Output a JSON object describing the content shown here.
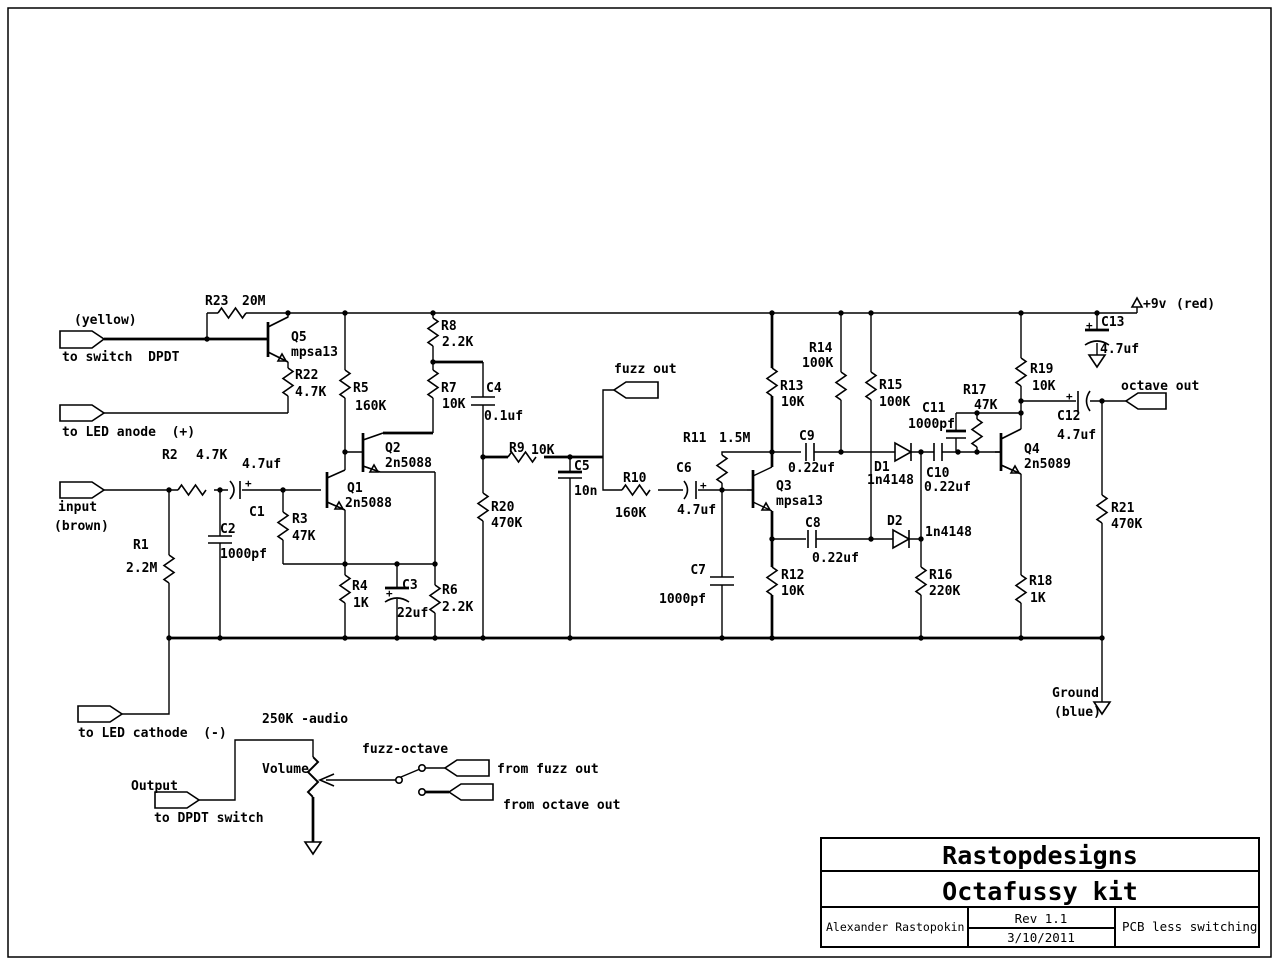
{
  "title_block": {
    "company": "Rastopdesigns",
    "project": "Octafussy kit",
    "author": "Alexander Rastopokin",
    "rev": "Rev 1.1",
    "date": "3/10/2011",
    "note": "PCB less switching"
  },
  "labels": {
    "yellow": "(yellow)",
    "to_switch": "to switch  DPDT",
    "to_led_anode": "to LED anode  (+)",
    "input": "input",
    "brown": "(brown)",
    "to_led_cathode": "to LED cathode  (-)",
    "output": "Output",
    "to_dpdt": "to DPDT switch",
    "fuzz_out": "fuzz out",
    "octave_out": "octave out",
    "from_fuzz_out": "from fuzz out",
    "from_octave_out": "from octave out",
    "pot_value": "250K -audio",
    "pot_name": "Volume",
    "switch_name": "fuzz-octave",
    "plus9v": "+9v",
    "red": "(red)",
    "ground": "Ground",
    "blue": "(blue)",
    "plus": "+"
  },
  "components": {
    "R1": {
      "ref": "R1",
      "value": "2.2M"
    },
    "R2": {
      "ref": "R2",
      "value": "4.7K"
    },
    "R3": {
      "ref": "R3",
      "value": "47K"
    },
    "R4": {
      "ref": "R4",
      "value": "1K"
    },
    "R5": {
      "ref": "R5",
      "value": "160K"
    },
    "R6": {
      "ref": "R6",
      "value": "2.2K"
    },
    "R7": {
      "ref": "R7",
      "value": "10K"
    },
    "R8": {
      "ref": "R8",
      "value": "2.2K"
    },
    "R9": {
      "ref": "R9",
      "value": "10K"
    },
    "R10": {
      "ref": "R10",
      "value": "160K"
    },
    "R11": {
      "ref": "R11",
      "value": "1.5M"
    },
    "R12": {
      "ref": "R12",
      "value": "10K"
    },
    "R13": {
      "ref": "R13",
      "value": "10K"
    },
    "R14": {
      "ref": "R14",
      "value": "100K"
    },
    "R15": {
      "ref": "R15",
      "value": "100K"
    },
    "R16": {
      "ref": "R16",
      "value": "220K"
    },
    "R17": {
      "ref": "R17",
      "value": "47K"
    },
    "R18": {
      "ref": "R18",
      "value": "1K"
    },
    "R19": {
      "ref": "R19",
      "value": "10K"
    },
    "R20": {
      "ref": "R20",
      "value": "470K"
    },
    "R21": {
      "ref": "R21",
      "value": "470K"
    },
    "R22": {
      "ref": "R22",
      "value": "4.7K"
    },
    "R23": {
      "ref": "R23",
      "value": "20M"
    },
    "C1": {
      "ref": "C1",
      "value": "4.7uf"
    },
    "C2": {
      "ref": "C2",
      "value": "1000pf"
    },
    "C3": {
      "ref": "C3",
      "value": "22uf"
    },
    "C4": {
      "ref": "C4",
      "value": "0.1uf"
    },
    "C5": {
      "ref": "C5",
      "value": "10n"
    },
    "C6": {
      "ref": "C6",
      "value": "4.7uf"
    },
    "C7": {
      "ref": "C7",
      "value": "1000pf"
    },
    "C8": {
      "ref": "C8",
      "value": "0.22uf"
    },
    "C9": {
      "ref": "C9",
      "value": "0.22uf"
    },
    "C10": {
      "ref": "C10",
      "value": "0.22uf"
    },
    "C11": {
      "ref": "C11",
      "value": "1000pf"
    },
    "C12": {
      "ref": "C12",
      "value": "4.7uf"
    },
    "C13": {
      "ref": "C13",
      "value": "4.7uf"
    },
    "D1": {
      "ref": "D1",
      "value": "1n4148"
    },
    "D2": {
      "ref": "D2",
      "value": "1n4148"
    },
    "Q1": {
      "ref": "Q1",
      "value": "2n5088"
    },
    "Q2": {
      "ref": "Q2",
      "value": "2n5088"
    },
    "Q3": {
      "ref": "Q3",
      "value": "mpsa13"
    },
    "Q4": {
      "ref": "Q4",
      "value": "2n5089"
    },
    "Q5": {
      "ref": "Q5",
      "value": "mpsa13"
    }
  }
}
